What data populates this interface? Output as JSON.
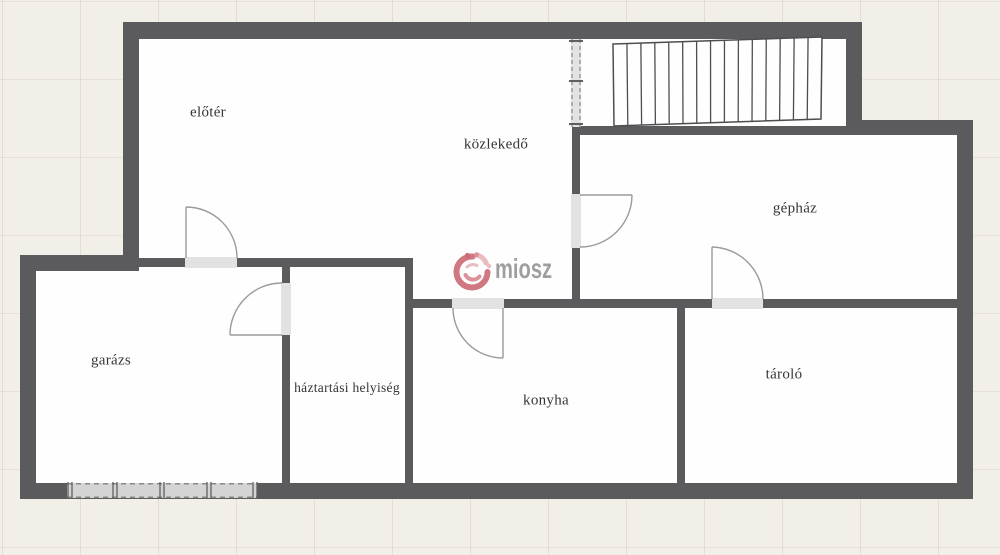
{
  "watermark": {
    "text": "miosz"
  },
  "colors": {
    "wall": "#5b5b5e",
    "floor": "#fefefe",
    "background": "#f2efe9",
    "opening": "#e2e2e2",
    "door_line": "#9a9a9a",
    "stair_line": "#4e4e52",
    "garage_door_fill": "#d4d4d4",
    "garage_door_dash": "#6f6f6f",
    "dash_line": "#8a8a8a",
    "tick": "#5f5f63",
    "label": "#35353a",
    "logo_pink": "#c9606c",
    "logo_pink_light": "#e6b2b6",
    "logo_pink_mid": "#d77f89",
    "logo_dot_dark": "#b94a57",
    "logo_text": "#8f8f8f"
  },
  "rooms": [
    {
      "id": "eloter",
      "label": "előtér",
      "x": 208,
      "y": 113
    },
    {
      "id": "kozlekedo",
      "label": "közlekedő",
      "x": 496,
      "y": 145
    },
    {
      "id": "gephaz",
      "label": "gépház",
      "x": 795,
      "y": 209
    },
    {
      "id": "garazs",
      "label": "garázs",
      "x": 111,
      "y": 361
    },
    {
      "id": "haztartasi",
      "label": "háztartási helyiség",
      "x": 347,
      "y": 388
    },
    {
      "id": "konyha",
      "label": "konyha",
      "x": 546,
      "y": 401
    },
    {
      "id": "tarolo",
      "label": "tároló",
      "x": 784,
      "y": 375
    }
  ],
  "plan": {
    "floors": [
      [
        139,
        39,
        433,
        260
      ],
      [
        580,
        39,
        267,
        88
      ],
      [
        580,
        135,
        377,
        164
      ],
      [
        36,
        267,
        246,
        216
      ],
      [
        290,
        267,
        115,
        216
      ],
      [
        413,
        308,
        264,
        175
      ],
      [
        685,
        308,
        272,
        175
      ]
    ],
    "walls": [
      [
        123,
        22,
        739,
        17
      ],
      [
        123,
        22,
        16,
        249
      ],
      [
        20,
        255,
        119,
        16
      ],
      [
        20,
        255,
        16,
        244
      ],
      [
        20,
        483,
        953,
        16
      ],
      [
        957,
        120,
        16,
        379
      ],
      [
        847,
        120,
        126,
        15
      ],
      [
        846,
        22,
        16,
        113
      ],
      [
        139,
        258,
        273,
        9
      ],
      [
        282,
        258,
        8,
        225
      ],
      [
        405,
        258,
        8,
        225
      ],
      [
        405,
        299,
        552,
        9
      ],
      [
        677,
        308,
        8,
        175
      ],
      [
        572,
        127,
        8,
        172
      ],
      [
        580,
        126,
        267,
        9
      ]
    ],
    "openings": [
      [
        185,
        257,
        52,
        11
      ],
      [
        281,
        283,
        10,
        52
      ],
      [
        452,
        298,
        52,
        11
      ],
      [
        712,
        298,
        51,
        11
      ],
      [
        571,
        194,
        10,
        54
      ]
    ],
    "doors": [
      {
        "leaf": [
          186,
          258,
          186,
          207
        ],
        "arc": "M186 207 A51 51 0 0 1 237 258"
      },
      {
        "leaf": [
          282,
          335,
          230,
          335
        ],
        "arc": "M230 335 A52 52 0 0 1 282 283"
      },
      {
        "leaf": [
          503,
          308,
          503,
          358
        ],
        "arc": "M453 308 A50 50 0 0 0 503 358"
      },
      {
        "leaf": [
          712,
          299,
          712,
          247
        ],
        "arc": "M712 247 A52 52 0 0 1 763 299"
      },
      {
        "leaf": [
          580,
          195,
          632,
          195
        ],
        "arc": "M632 195 A52 52 0 0 1 580 247"
      }
    ],
    "stairs": {
      "corners": [
        [
          613,
          44
        ],
        [
          822,
          37
        ],
        [
          821,
          119
        ],
        [
          614,
          126
        ]
      ],
      "treads": 15
    },
    "dashed_partition": {
      "rect": [
        571,
        39,
        10,
        88
      ],
      "ticks_y": [
        41,
        81,
        124
      ]
    },
    "garage_door": {
      "rect": [
        67,
        483,
        190,
        15
      ],
      "ticks_x": [
        67,
        112,
        159,
        206,
        252
      ]
    }
  }
}
